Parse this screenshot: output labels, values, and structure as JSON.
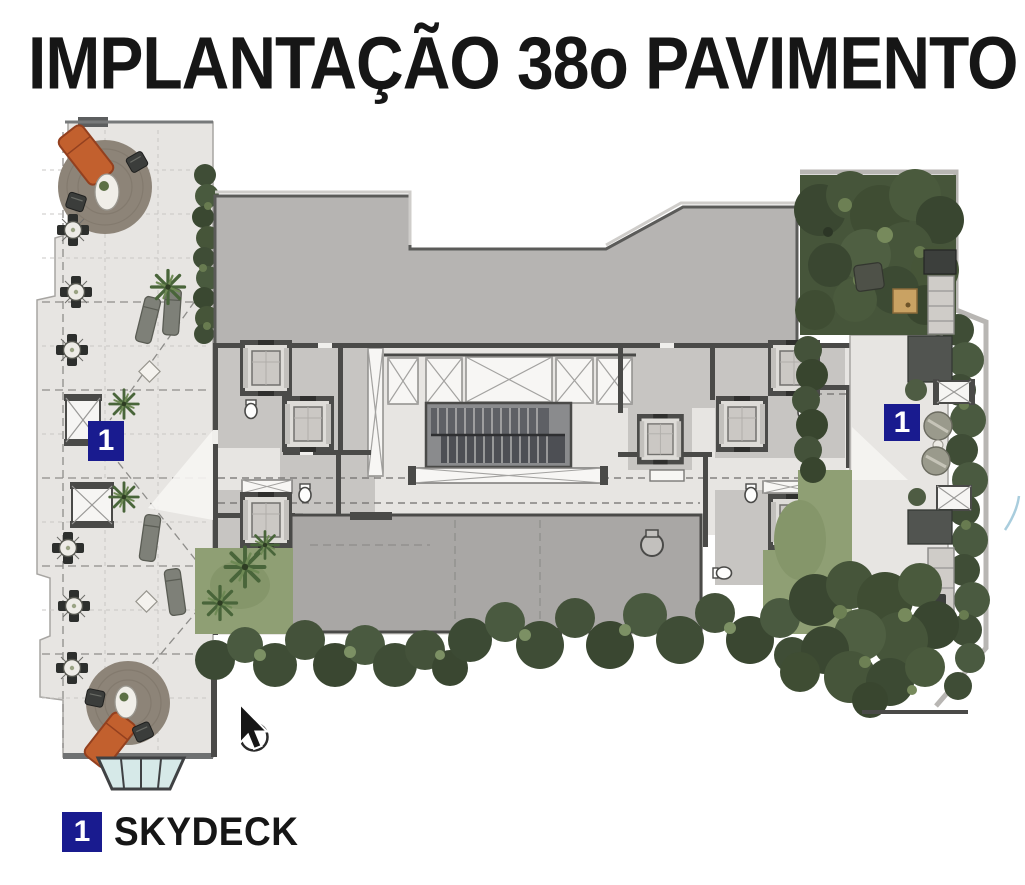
{
  "title": "IMPLANTAÇÃO 38o PAVIMENTO",
  "plan": {
    "markers": [
      "1",
      "1"
    ]
  },
  "legend": {
    "items": [
      {
        "marker": "1",
        "label": "SKYDECK"
      }
    ]
  },
  "colors": {
    "marker_blue": "#191b8f",
    "title_black": "#161616",
    "wall_dark": "#4a4a48",
    "roof_gray": "#b6b4b2",
    "slab_gray": "#a9a7a5",
    "floor_light": "#e7e5e2",
    "grass_green": "#8f9f74",
    "hedge_green": "#3e4c36",
    "wood_tan": "#c9a263",
    "lounger_orange": "#c2602e",
    "glass_blue": "#d6e9e8"
  }
}
